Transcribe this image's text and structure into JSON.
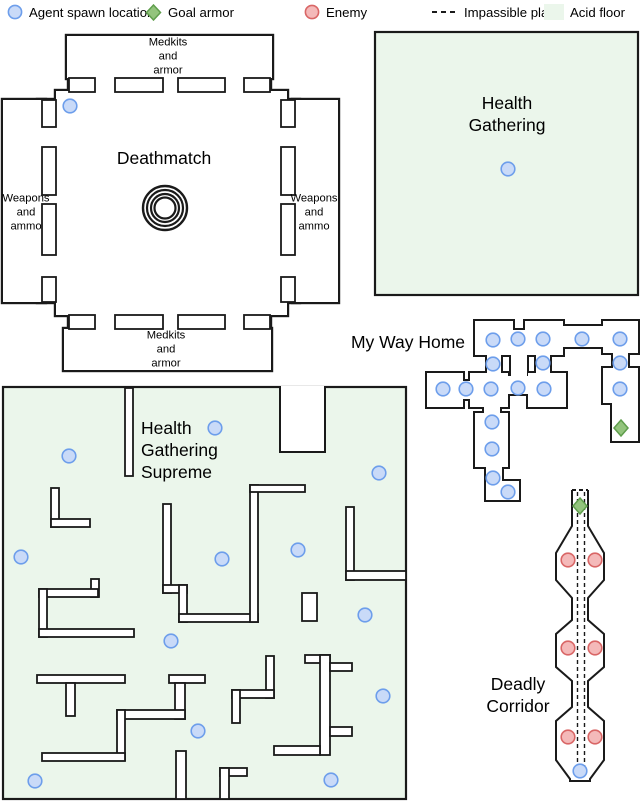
{
  "legend": {
    "items": [
      {
        "icon": "spawn-icon",
        "label": "Agent spawn location"
      },
      {
        "icon": "goal-icon",
        "label": "Goal armor"
      },
      {
        "icon": "enemy-icon",
        "label": "Enemy"
      },
      {
        "icon": "dashed-icon",
        "label": "Impassible plane"
      },
      {
        "icon": "acid-icon",
        "label": "Acid floor"
      }
    ]
  },
  "colors": {
    "spawn_fill": "#c9daf8",
    "spawn_stroke": "#6d9eeb",
    "enemy_fill": "#f4b9b9",
    "enemy_stroke": "#d96666",
    "goal_fill": "#93c47d",
    "goal_stroke": "#5f9e4c",
    "acid_floor": "#ebf6eb",
    "wall": "#1a1a1a"
  },
  "maps": {
    "deathmatch": {
      "title": "Deathmatch",
      "room_labels": {
        "top": "Medkits\nand\narmor",
        "bottom": "Medkits\nand\narmor",
        "left": "Weapons\nand\nammo",
        "right": "Weapons\nand\nammo"
      },
      "spawns": [
        [
          70,
          106
        ]
      ]
    },
    "health_gathering": {
      "title": "Health\nGathering",
      "spawns": [
        [
          508,
          169
        ]
      ]
    },
    "my_way_home": {
      "title": "My Way Home",
      "spawns": [
        [
          493,
          340
        ],
        [
          518,
          339
        ],
        [
          543,
          339
        ],
        [
          582,
          339
        ],
        [
          620,
          339
        ],
        [
          493,
          364
        ],
        [
          543,
          363
        ],
        [
          620,
          363
        ],
        [
          443,
          389
        ],
        [
          466,
          389
        ],
        [
          491,
          389
        ],
        [
          518,
          388
        ],
        [
          544,
          389
        ],
        [
          620,
          389
        ],
        [
          492,
          422
        ],
        [
          492,
          449
        ],
        [
          493,
          478
        ],
        [
          508,
          492
        ]
      ],
      "goals": [
        [
          621,
          428
        ]
      ]
    },
    "health_gathering_supreme": {
      "title": "Health\nGathering\nSupreme",
      "spawns": [
        [
          215,
          428
        ],
        [
          69,
          456
        ],
        [
          379,
          473
        ],
        [
          21,
          557
        ],
        [
          222,
          559
        ],
        [
          298,
          550
        ],
        [
          365,
          615
        ],
        [
          171,
          641
        ],
        [
          383,
          696
        ],
        [
          198,
          731
        ],
        [
          35,
          781
        ],
        [
          331,
          780
        ]
      ]
    },
    "deadly_corridor": {
      "title": "Deadly\nCorridor",
      "spawns": [
        [
          580,
          771
        ]
      ],
      "goals": [
        [
          580,
          506
        ]
      ],
      "enemies": [
        [
          568,
          560
        ],
        [
          595,
          560
        ],
        [
          568,
          648
        ],
        [
          595,
          648
        ],
        [
          568,
          737
        ],
        [
          595,
          737
        ]
      ]
    }
  }
}
